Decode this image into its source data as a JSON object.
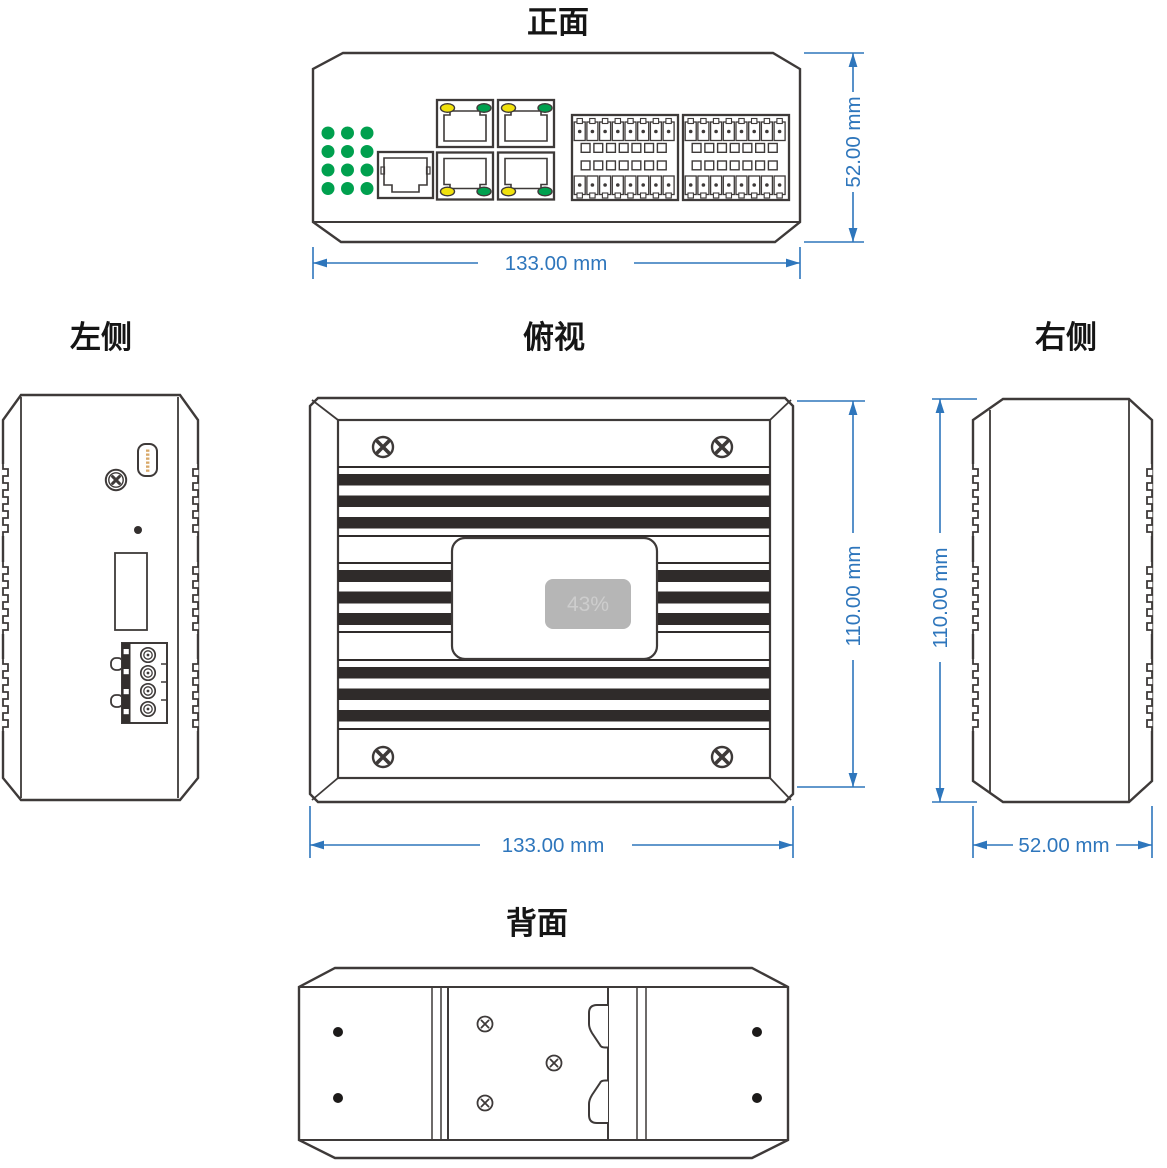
{
  "views": {
    "front": {
      "title": "正面",
      "width_dim": "133.00 mm",
      "height_dim": "52.00 mm"
    },
    "top": {
      "title": "俯视",
      "width_dim": "133.00 mm",
      "height_dim": "110.00 mm",
      "label_text": "43%"
    },
    "left": {
      "title": "左侧"
    },
    "right": {
      "title": "右侧",
      "height_dim": "110.00 mm",
      "width_dim": "52.00 mm"
    },
    "back": {
      "title": "背面"
    }
  },
  "colors": {
    "outline": "#3e3a39",
    "dimension_blue": "#2e76bc",
    "led_green": "#00a04e",
    "led_yellow": "#f0e10c",
    "contact_gold": "#d8a868",
    "label_gray": "#b6b6b6",
    "label_text_gray": "#cdcdcd",
    "fin_stripe": "#2f2b2a"
  }
}
